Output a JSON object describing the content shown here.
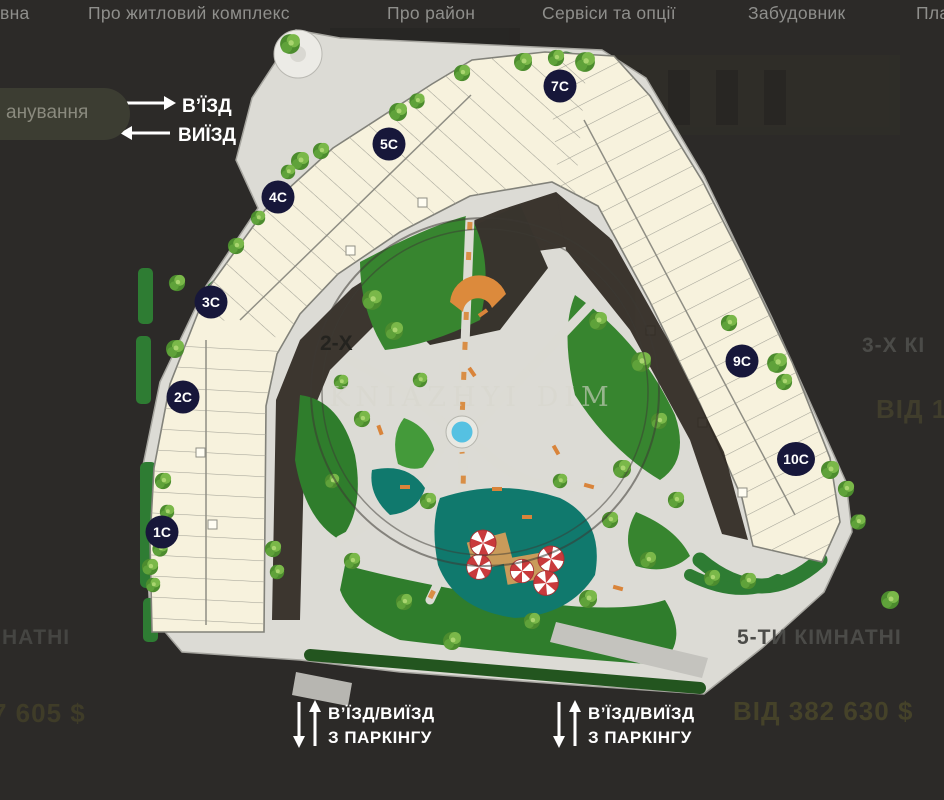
{
  "nav": {
    "items": [
      {
        "label": "вна"
      },
      {
        "label": "Про житловий комплекс"
      },
      {
        "label": "Про район"
      },
      {
        "label": "Сервіси та опції"
      },
      {
        "label": "Забудовник"
      },
      {
        "label": "План"
      }
    ]
  },
  "plan_button": {
    "label": "анування"
  },
  "entrance": {
    "in": "В’ЇЗД",
    "out": "ВИЇЗД"
  },
  "parking": {
    "line1": "В’ЇЗД/ВИЇЗД",
    "line2": "З ПАРКІНГУ"
  },
  "watermark": {
    "text": "KNIAZHYI DIM"
  },
  "sections": [
    "1С",
    "2С",
    "3С",
    "4С",
    "5С",
    "7С",
    "9С",
    "10С"
  ],
  "apartments": {
    "left_center_fragment": "2-Х",
    "right_center_title_fragment": "3-Х КІ",
    "right_center_price_fragment": "ВІД 1",
    "bottom_left_title_fragment": "НАТНІ",
    "bottom_left_price_fragment": "7 605 $",
    "bottom_right_title": "5-ТИ КІМНАТНІ",
    "bottom_right_price": "ВІД 382 630 $"
  },
  "colors": {
    "background": "#2c2a28",
    "building": "#f7f2dd",
    "sidewalk": "#dcdbd5",
    "lawn": "#37852f",
    "pond": "#10796d",
    "fountain": "#55c1e2",
    "umbrella_red": "#c93a3c",
    "bench_orange": "#d9843a",
    "badge_navy": "#17173a"
  }
}
